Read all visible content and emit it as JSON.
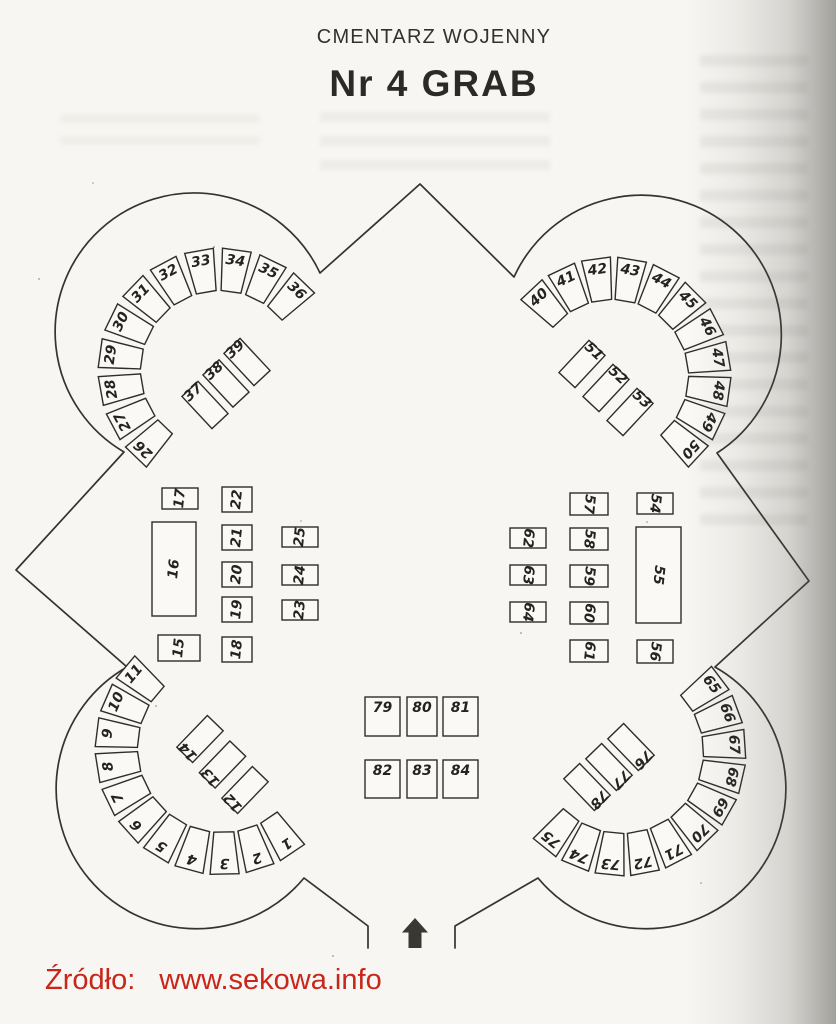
{
  "header": {
    "subtitle": "CMENTARZ WOJENNY",
    "title": "Nr 4 GRAB"
  },
  "footer": {
    "source_label": "Źródło:",
    "source_url": "www.sekowa.info"
  },
  "colors": {
    "ink": "#2f2d29",
    "paper": "#f7f6f2",
    "source_red": "#c8261a",
    "arrow": "#3a3832"
  },
  "icons": {
    "entrance": "entrance-arrow"
  },
  "plan": {
    "lobes": {
      "top_left": {
        "outer": [
          "26",
          "27",
          "28",
          "29",
          "30",
          "31",
          "32",
          "33",
          "34",
          "35",
          "36"
        ],
        "inner": [
          "37",
          "38",
          "39"
        ]
      },
      "top_right": {
        "outer": [
          "40",
          "41",
          "42",
          "43",
          "44",
          "45",
          "46",
          "47",
          "48",
          "49",
          "50"
        ],
        "inner": [
          "51",
          "52",
          "53"
        ]
      },
      "bottom_left": {
        "outer": [
          "1",
          "2",
          "3",
          "4",
          "5",
          "6",
          "7",
          "8",
          "9",
          "10",
          "11"
        ],
        "inner": [
          "12",
          "13",
          "14"
        ]
      },
      "bottom_right": {
        "outer": [
          "65",
          "66",
          "67",
          "68",
          "69",
          "70",
          "71",
          "72",
          "73",
          "74",
          "75"
        ],
        "inner": [
          "76",
          "77",
          "78"
        ]
      }
    },
    "center_left": {
      "col_a": [
        "17",
        "16",
        "15"
      ],
      "col_b": [
        "22",
        "21",
        "20",
        "19",
        "18"
      ],
      "col_c": [
        "25",
        "24",
        "23"
      ]
    },
    "center_right": {
      "col_a": [
        "54",
        "55",
        "56"
      ],
      "col_b": [
        "57",
        "58",
        "59",
        "60",
        "61"
      ],
      "col_c": [
        "62",
        "63",
        "64"
      ]
    },
    "bottom_center": {
      "row_1": [
        "79",
        "80",
        "81"
      ],
      "row_2": [
        "82",
        "83",
        "84"
      ]
    }
  }
}
